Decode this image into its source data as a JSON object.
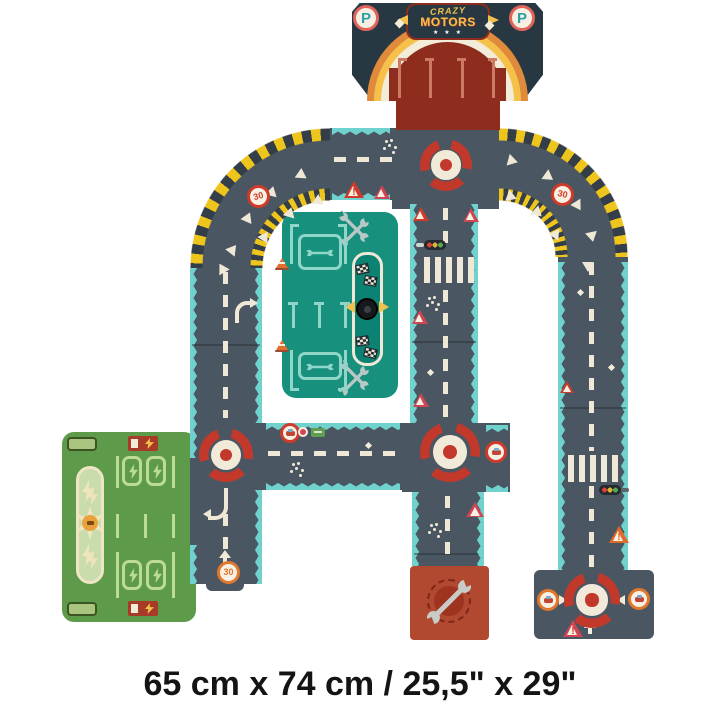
{
  "caption": "65 cm x 74 cm / 25,5\" x 29\"",
  "logo": {
    "line1": "CRAZY",
    "line2": "MOTORS",
    "stars": "★ ★ ★"
  },
  "signs": {
    "parking_letter": "P",
    "speed_limit": "30",
    "warning_mark": "!"
  },
  "colors": {
    "road": "#4a5661",
    "edge_teal": "#6fd2cc",
    "hazard_yellow": "#eec51c",
    "navy_panel": "#273843",
    "lot_red": "#8e2d1e",
    "accent_red": "#c2392b",
    "garage_teal": "#17907e",
    "parking_green": "#5d9b4a",
    "marking_cream": "#efe8d6",
    "repair_rust": "#b0492f"
  },
  "icons": {
    "parking-badge-icon": "circle-P",
    "roundabout-icon": "red-arc-ring",
    "speed-30-sign": "red-circle-30",
    "warning-triangle-icon": "triangle-exclaim",
    "traffic-light-icon": "three-dot-signal",
    "crosswalk-icon": "white-bars",
    "wrench-icon": "open-end-wrench",
    "checkered-flag-icon": "bw-checker",
    "tire-icon": "black-tire",
    "traffic-cone-icon": "orange-cone",
    "lightning-icon": "yellow-bolt",
    "charging-station-icon": "sunburst-plug",
    "rainbow-arch-icon": "orange-yellow-arch"
  }
}
